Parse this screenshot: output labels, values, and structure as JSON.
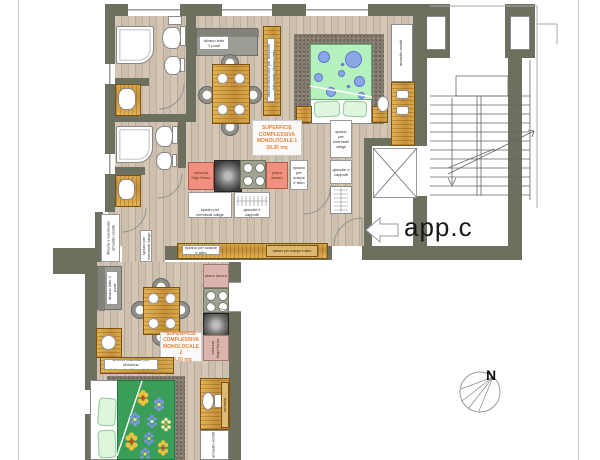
{
  "plan": {
    "app_label": "app.c",
    "compass_north": "N",
    "monolocale1": {
      "area_label": "SUPERFICIE\nCOMPLESSIVA\nMONOLOCALE 1\n28.30 mq",
      "sofa": "divano letto\n2 posti",
      "divider": "libreria bifacciale per divisione letto matr. /divano letto",
      "wardrobe": "armadio vestiti",
      "fridge_column": "colonna\nfrigo+forno",
      "worktop": "piano lavoro",
      "shoe_shelf": "ripiano\nper\nscarpe\ne altro",
      "luggage": "spazio per\neventuali valige",
      "coats": "giacche e\ncappotti",
      "entry_luggage": "spazio\nper\neventuali\nvalige",
      "entry_coats": "giacche e\ncappotti",
      "bench_a": "ripiano per scarpe\ne altro",
      "bench_b": "ripiano per scarpe e altro"
    },
    "monolocale2": {
      "area_label": "SUPERFICIE\nCOMPLESSIVA\nMONOLOCALE 2\n29.20 mq",
      "sofa": "divano letto 2 posti",
      "side_cabinet": "libreria o eventuale armadio vestiti",
      "hall_closet": "spazio per eventuali valige",
      "divider": "libreria bifacciale per divisione\nletto matr. /divano letto",
      "fridge_column": "colonna\nfrigo+forno",
      "worktop": "piano lavoro",
      "desk": "scrivania",
      "wardrobe": "armadio vestiti"
    },
    "colors": {
      "wall": "#6d705e",
      "salmon": "#f2907f",
      "dusty_pink": "#dcb4ae",
      "area_text": "#e8833c",
      "duvet_green_light": "#b5f0bf",
      "duvet_green_dark": "#3a9e58",
      "carpet": "#847b6f"
    }
  }
}
